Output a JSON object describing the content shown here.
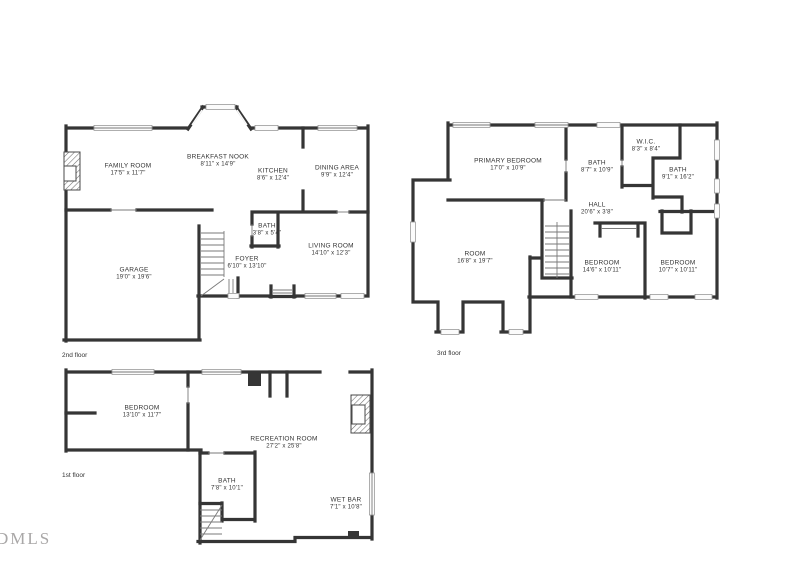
{
  "watermark": "DMLS",
  "floors": [
    {
      "label": "2nd floor",
      "rooms": [
        {
          "name": "FAMILY ROOM",
          "dims": "17'5\" x 11'7\""
        },
        {
          "name": "BREAKFAST NOOK",
          "dims": "8'11\" x 14'9\""
        },
        {
          "name": "KITCHEN",
          "dims": "8'6\" x 12'4\""
        },
        {
          "name": "DINING AREA",
          "dims": "9'9\" x 12'4\""
        },
        {
          "name": "BATH",
          "dims": "3'8\" x 5'4\""
        },
        {
          "name": "FOYER",
          "dims": "6'10\" x 13'10\""
        },
        {
          "name": "LIVING ROOM",
          "dims": "14'10\" x 12'3\""
        },
        {
          "name": "GARAGE",
          "dims": "19'0\" x 19'6\""
        }
      ]
    },
    {
      "label": "3rd floor",
      "rooms": [
        {
          "name": "PRIMARY BEDROOM",
          "dims": "17'0\" x 10'9\""
        },
        {
          "name": "BATH",
          "dims": "8'7\" x 10'9\""
        },
        {
          "name": "W.I.C.",
          "dims": "8'3\" x 8'4\""
        },
        {
          "name": "BATH",
          "dims": "9'1\" x 16'2\""
        },
        {
          "name": "HALL",
          "dims": "20'6\" x 3'8\""
        },
        {
          "name": "ROOM",
          "dims": "16'8\" x 19'7\""
        },
        {
          "name": "BEDROOM",
          "dims": "14'6\" x 10'11\""
        },
        {
          "name": "BEDROOM",
          "dims": "10'7\" x 10'11\""
        }
      ]
    },
    {
      "label": "1st floor",
      "rooms": [
        {
          "name": "BEDROOM",
          "dims": "13'10\" x 11'7\""
        },
        {
          "name": "RECREATION ROOM",
          "dims": "27'2\" x 25'8\""
        },
        {
          "name": "BATH",
          "dims": "7'8\" x 10'1\""
        },
        {
          "name": "WET BAR",
          "dims": "7'1\" x 10'8\""
        }
      ]
    }
  ]
}
